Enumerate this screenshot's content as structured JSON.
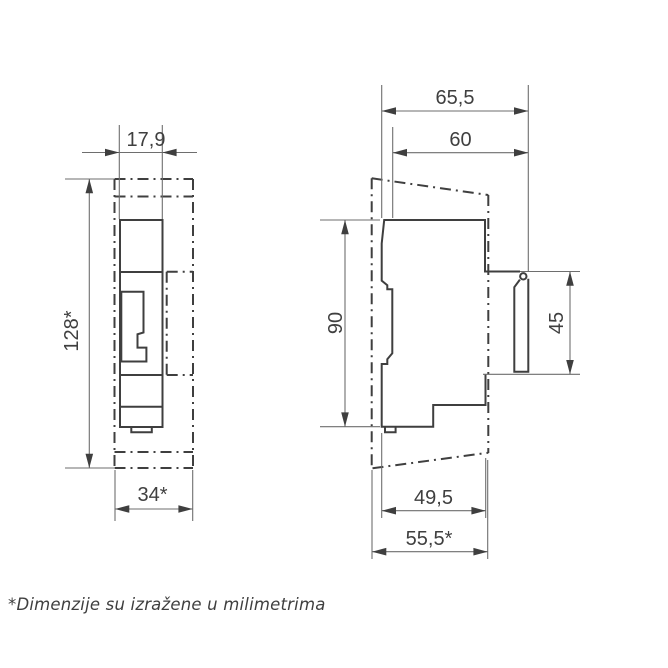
{
  "drawing": {
    "title": "device-dimension-drawing",
    "footnote": "*Dimenzije su izražene u milimetrima",
    "front_view": {
      "label": "front view",
      "dim_width_top": "17,9",
      "dim_height": "128*",
      "dim_width_bottom": "34*"
    },
    "side_view": {
      "label": "side view",
      "dim_depth_total": "65,5",
      "dim_depth_front": "60",
      "dim_height_body": "90",
      "dim_cover_height": "45",
      "dim_depth_lower": "49,5",
      "dim_depth_lower_total": "55,5*"
    },
    "colors": {
      "line": "#3f3f3f",
      "thin_line": "#6e6e6e",
      "background": "#ffffff"
    }
  }
}
